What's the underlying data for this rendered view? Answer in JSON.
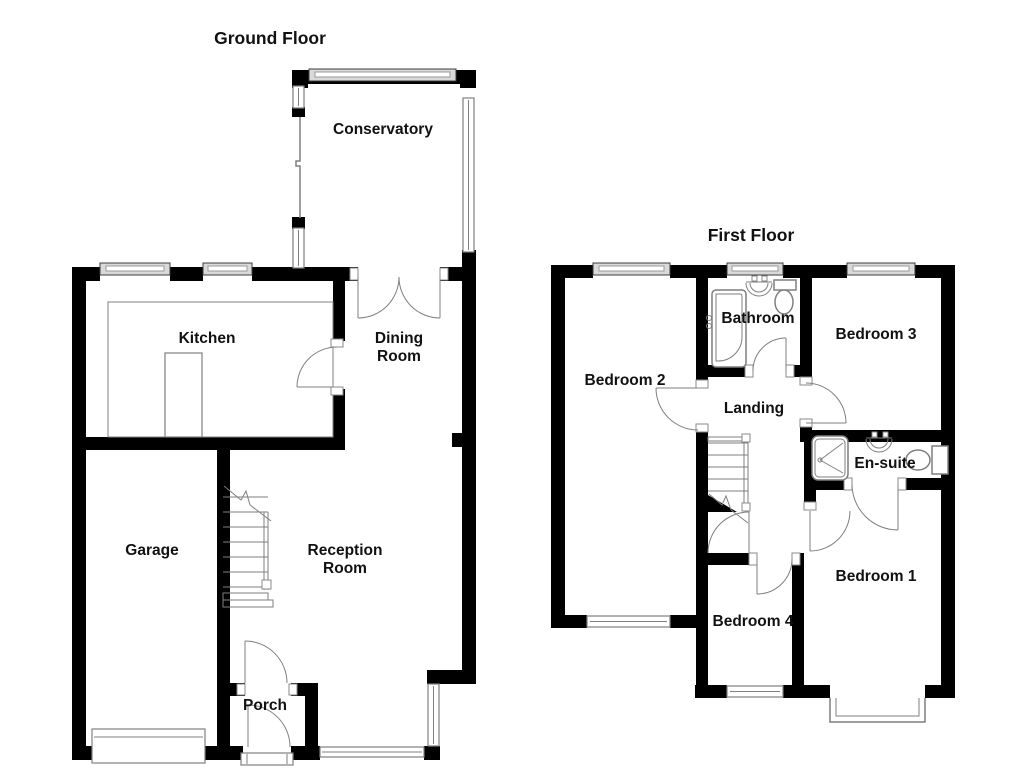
{
  "ground_floor": {
    "title": "Ground Floor",
    "rooms": {
      "conservatory": "Conservatory",
      "kitchen": "Kitchen",
      "dining_line1": "Dining",
      "dining_line2": "Room",
      "garage": "Garage",
      "reception_line1": "Reception",
      "reception_line2": "Room",
      "porch": "Porch"
    }
  },
  "first_floor": {
    "title": "First Floor",
    "rooms": {
      "bedroom2": "Bedroom 2",
      "bathroom": "Bathroom",
      "bedroom3": "Bedroom 3",
      "landing": "Landing",
      "ensuite": "En-suite",
      "bedroom1": "Bedroom 1",
      "bedroom4": "Bedroom 4"
    }
  },
  "colors": {
    "wall": "#000000",
    "line": "#7f7f7f",
    "text": "#111111",
    "winfill": "#d9d9d9",
    "bg": "#ffffff"
  }
}
